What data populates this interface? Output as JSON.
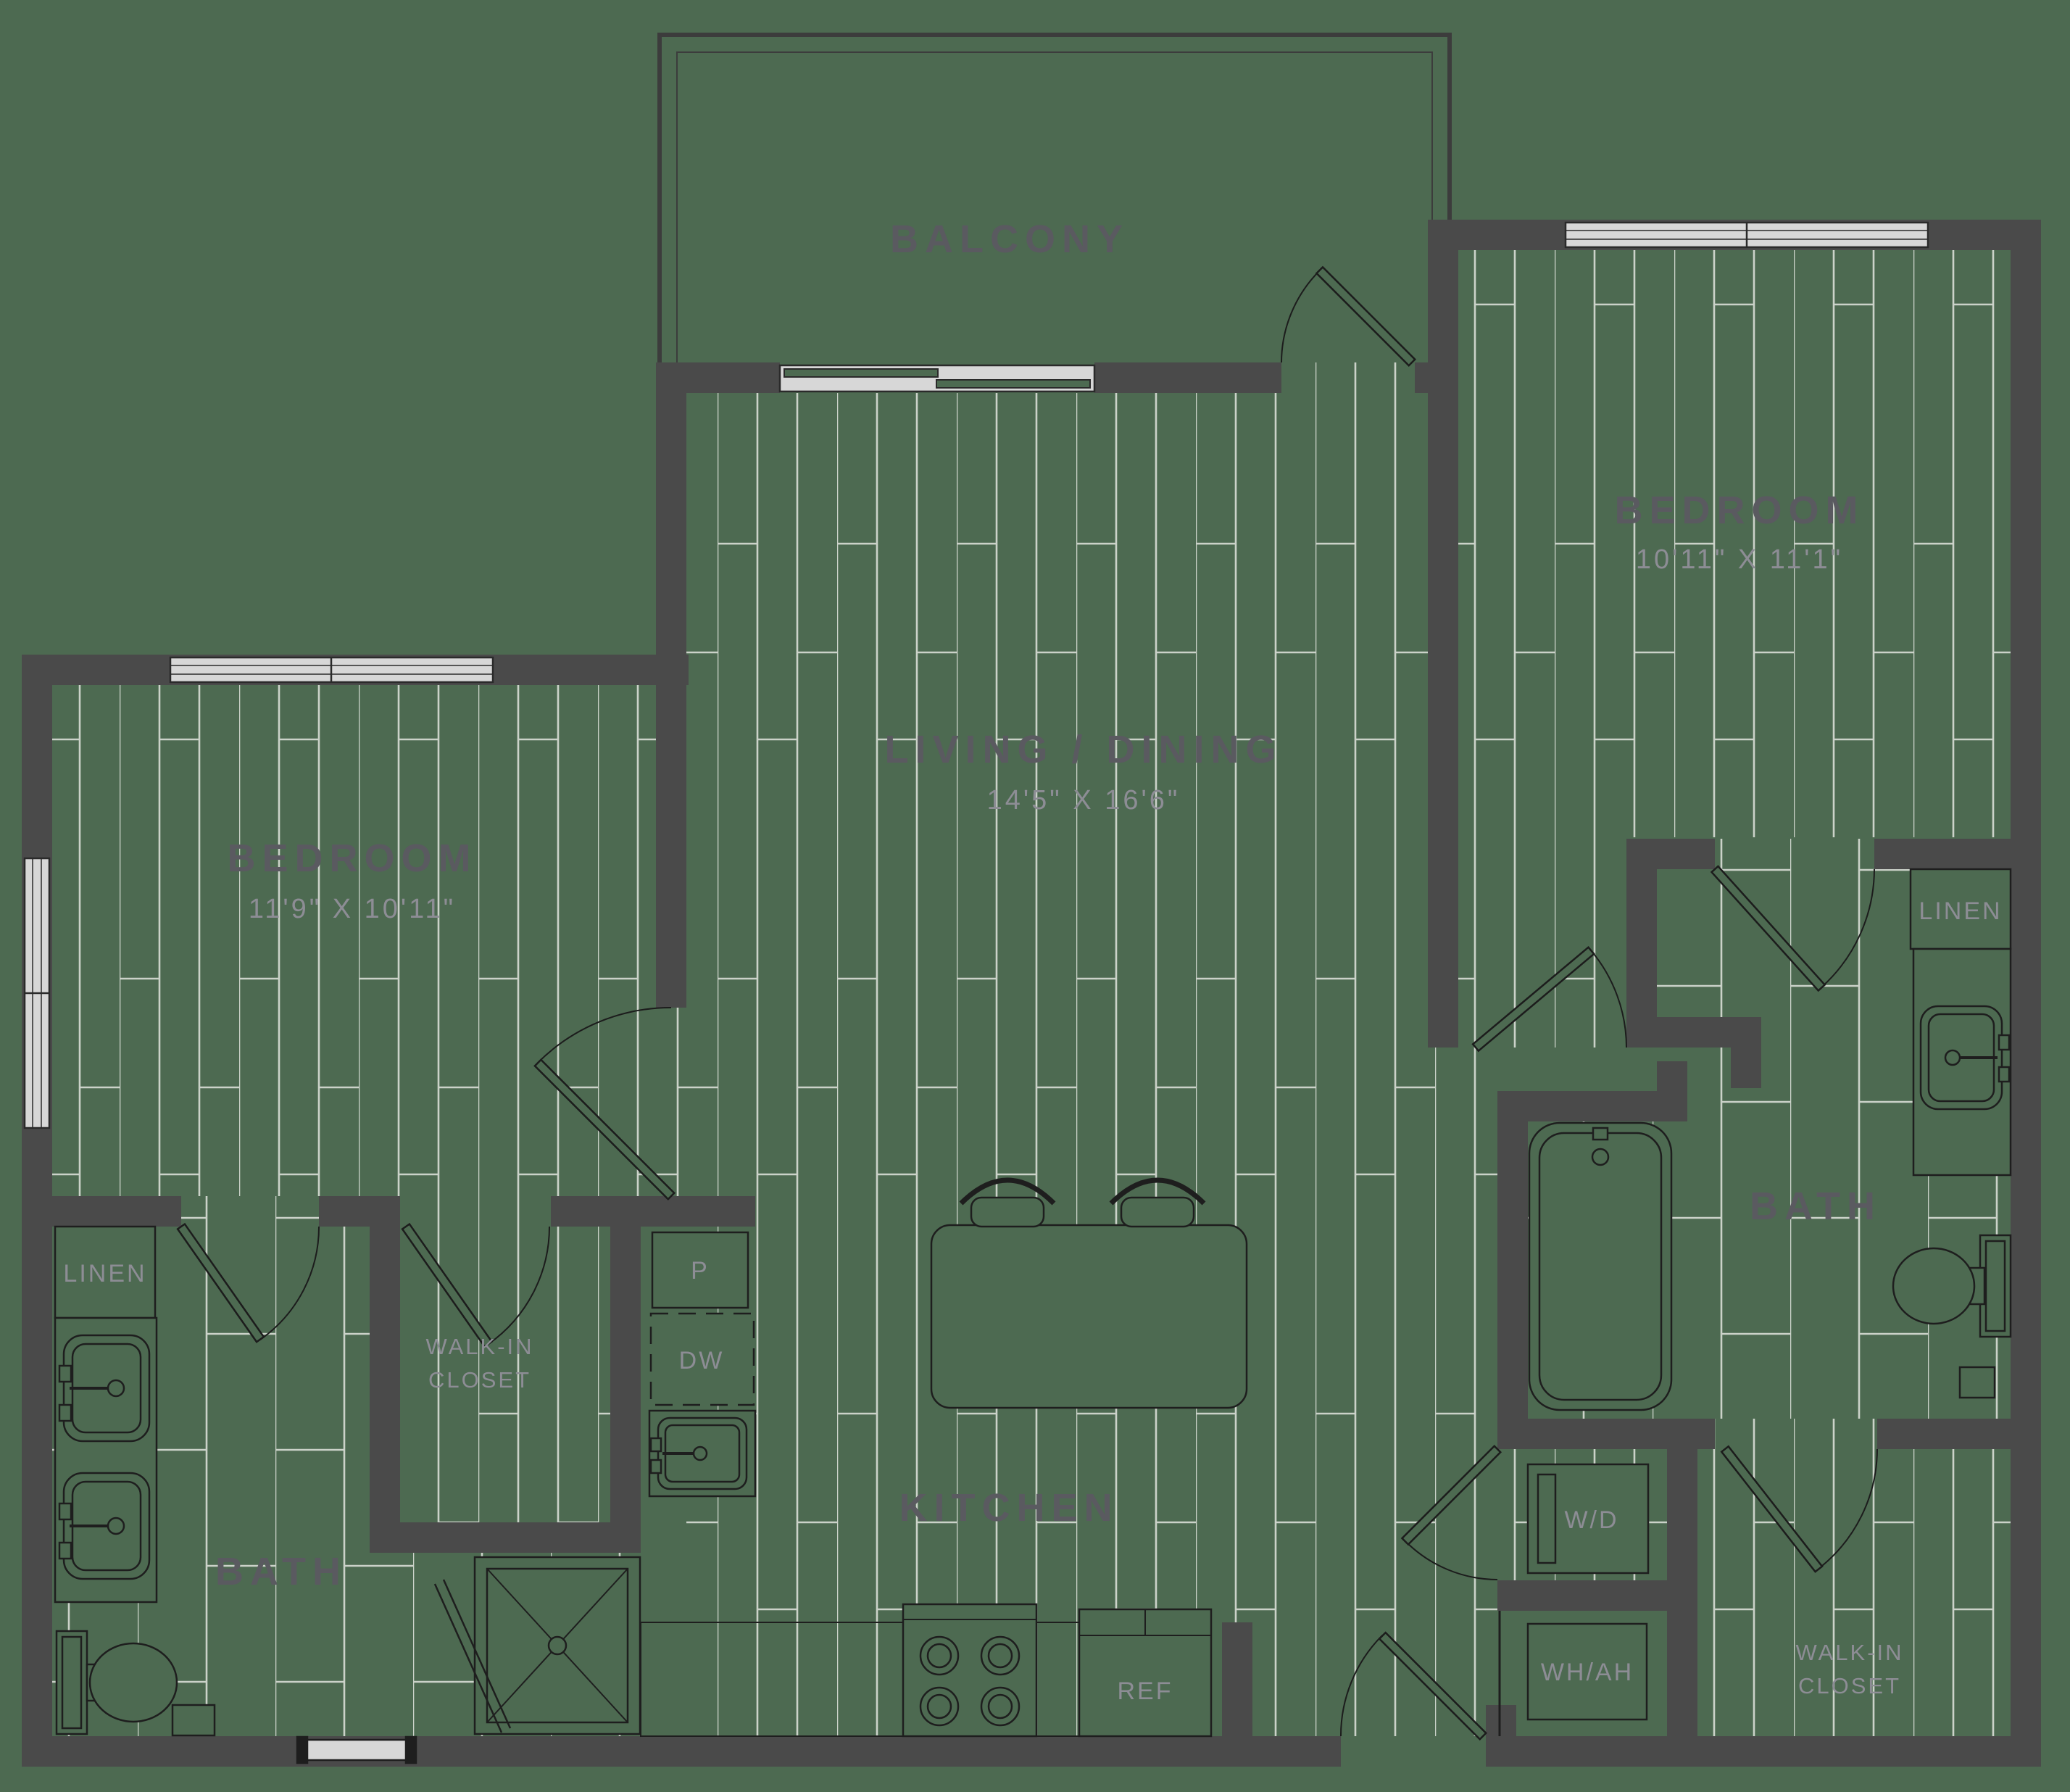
{
  "floor_plan": {
    "balcony": {
      "label": "BALCONY"
    },
    "living_dining": {
      "label": "LIVING / DINING",
      "dims": "14'5\" X 16'6\""
    },
    "bedroom_right": {
      "label": "BEDROOM",
      "dims": "10'11\" X 11'1\""
    },
    "bedroom_left": {
      "label": "BEDROOM",
      "dims": "11'9\" X 10'11\""
    },
    "kitchen": {
      "label": "KITCHEN",
      "pantry": "P",
      "dishwasher": "DW",
      "refrigerator": "REF"
    },
    "bath_left": {
      "label": "BATH",
      "linen": "LINEN"
    },
    "bath_right": {
      "label": "BATH",
      "linen": "LINEN"
    },
    "walk_in_closet_left": {
      "line1": "WALK-IN",
      "line2": "CLOSET"
    },
    "walk_in_closet_right": {
      "line1": "WALK-IN",
      "line2": "CLOSET"
    },
    "laundry": {
      "washer_dryer": "W/D",
      "water_heater_air_handler": "WH/AH"
    },
    "colors": {
      "floor_green": "#4d6a51",
      "wall_gray": "#4a4a4a",
      "plank_line": "#dde1da",
      "label_dark": "#5a5a60",
      "label_light": "#8d8d95",
      "window_fill": "#d7d7d7",
      "fixture_line": "#1e1e1e"
    }
  }
}
